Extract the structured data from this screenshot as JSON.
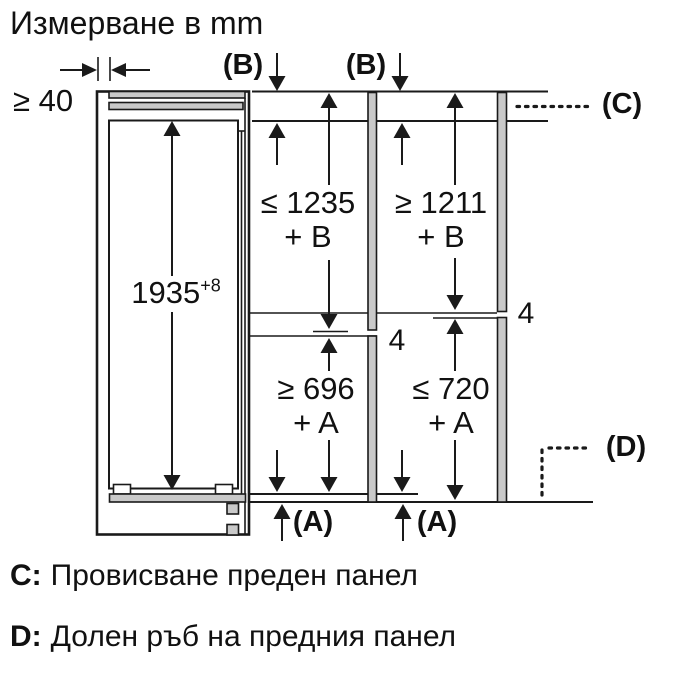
{
  "title": "Измерване в mm",
  "colors": {
    "ink": "#1a1a1a",
    "panel_gray": "#c9c9c9",
    "background": "#ffffff"
  },
  "dimensions": {
    "left_gap": "≥ 40",
    "niche_height": {
      "value": "1935",
      "tolerance_sup": "+8"
    },
    "col1_upper": {
      "line1": "≤ 1235",
      "line2": "+ B"
    },
    "col2_upper": {
      "line1": "≥ 1211",
      "line2": "+ B"
    },
    "col1_lower": {
      "line1": "≥ 696",
      "line2": "+ A"
    },
    "col2_lower": {
      "line1": "≤ 720",
      "line2": "+ A"
    },
    "panel_gap_left": "4",
    "panel_gap_right": "4"
  },
  "labels": {
    "b_top_left": "(B)",
    "b_top_right": "(B)",
    "c_ref": "(C)",
    "d_ref": "(D)",
    "a_bottom_left": "(A)",
    "a_bottom_right": "(A)"
  },
  "legend": {
    "c_key": "C:",
    "c_text": "Провисване преден панел",
    "d_key": "D:",
    "d_text": "Долен ръб на предния панел"
  }
}
